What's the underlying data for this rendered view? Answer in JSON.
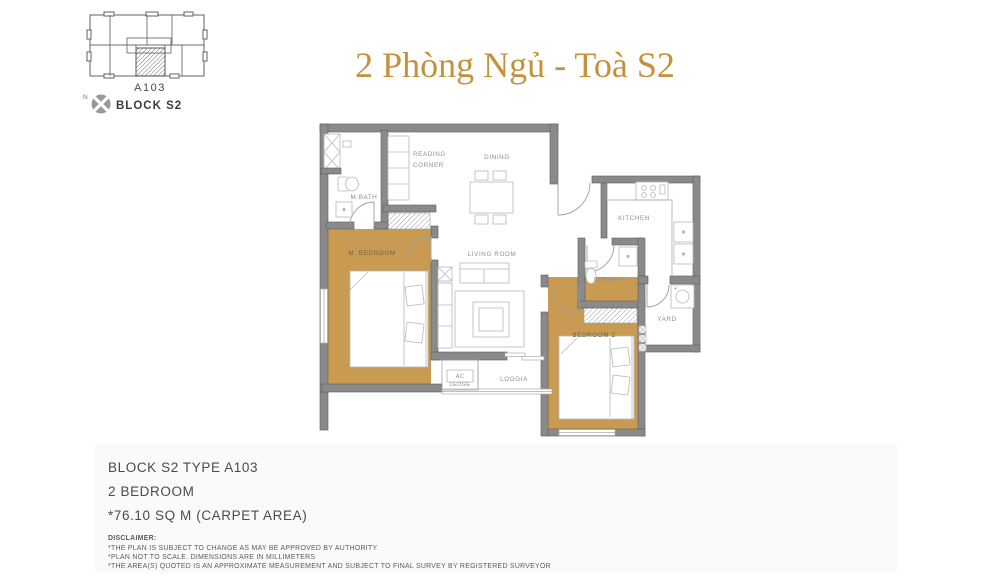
{
  "title": {
    "text": "2 Phòng Ngủ - Toà S2",
    "color": "#c4913c"
  },
  "key_plan": {
    "unit_label": "A103",
    "north_label": "N",
    "block_label": "BLOCK S2"
  },
  "plan": {
    "rooms": {
      "reading_corner_line1": "READING",
      "reading_corner_line2": "CORNER",
      "dining": "DINING",
      "kitchen": "KITCHEN",
      "m_bath": "M.BATH",
      "m_bedroom": "M. BEDROOM",
      "living_room": "LIVING ROOM",
      "com_bath": "COM.BATH",
      "bedroom_2": "BEDROOM 2",
      "yard": "YARD",
      "ac_ledge_line1": "AC",
      "ac_ledge_line2": "LEDGE",
      "loggia": "LOGGIA"
    }
  },
  "info_panel": {
    "line1": "BLOCK S2 TYPE A103",
    "line2": "2 BEDROOM",
    "line3": "*76.10 SQ M (CARPET AREA)",
    "disclaimer_title": "DISCLAIMER:",
    "disclaimers": [
      "*THE PLAN IS SUBJECT TO CHANGE AS MAY BE APPROVED BY AUTHORITY",
      "*PLAN NOT TO SCALE. DIMENSIONS ARE IN MILLIMETERS",
      "*THE AREA(S) QUOTED IS AN APPROXIMATE MEASUREMENT AND SUBJECT TO FINAL SURVEY BY REGISTERED SURVEYOR"
    ]
  },
  "colors": {
    "accent_gold": "#c4913c",
    "room_fill_gold": "#c89a52",
    "wall_gray": "#8a8a8a",
    "panel_bg": "#fafafa"
  }
}
